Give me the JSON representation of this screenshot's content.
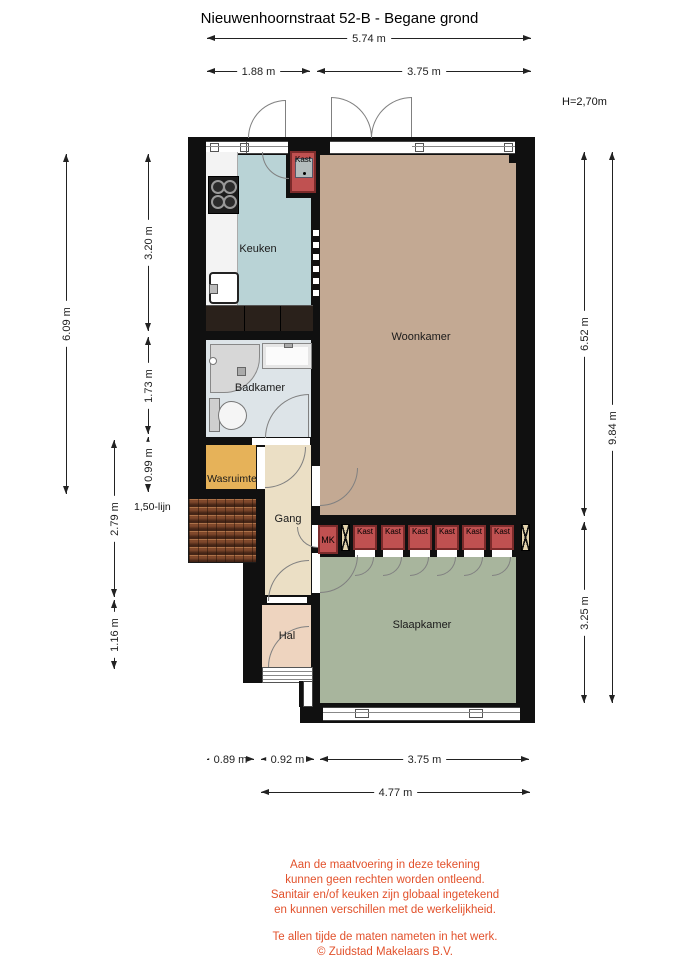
{
  "title": "Nieuwenhoornstraat 52-B - Begane grond",
  "labels": {
    "keuken": "Keuken",
    "woonkamer": "Woonkamer",
    "badkamer": "Badkamer",
    "wasruimte": "Wasruimte",
    "gang": "Gang",
    "hal": "Hal",
    "slaapkamer": "Slaapkamer",
    "kast": "Kast",
    "mk": "MK",
    "height": "H=2,70m",
    "line150": "1,50-lijn"
  },
  "dims": {
    "w_total": "5.74 m",
    "w_kitchen": "1.88 m",
    "w_living": "3.75 m",
    "h_left_total": "6.09 m",
    "h_kitchen": "3.20 m",
    "h_bath": "1.73 m",
    "h_wasruimte": "0.99 m",
    "h_gang": "2.79 m",
    "h_hal": "1.16 m",
    "h_right_upper": "6.52 m",
    "h_right_total": "9.84 m",
    "h_bedroom": "3.25 m",
    "b_left": "0.89 m",
    "b_mid": "0.92 m",
    "b_right": "3.75 m",
    "b_total": "4.77 m"
  },
  "disclaimer": {
    "lines": [
      "Aan de maatvoering in deze tekening",
      "kunnen geen rechten worden ontleend.",
      "Sanitair en/of keuken zijn globaal ingetekend",
      "en kunnen verschillen met de werkelijkheid."
    ],
    "notes": [
      "Te allen tijde de maten nameten in het werk.",
      "© Zuidstad Makelaars B.V."
    ]
  },
  "colors": {
    "wall": "#101010",
    "keuken": "#b9d3d6",
    "woonkamer": "#c3a993",
    "badkamer": "#dde4e8",
    "wasruimte": "#e6b259",
    "gang": "#ebdfc5",
    "hal": "#eed4bf",
    "slaapkamer": "#a8b59d",
    "kastred": "#c05151",
    "kastborder": "#7c2b2b",
    "xbox": "#e3d3ac",
    "tilesbase": "#7a452a",
    "accent": "#e2512b",
    "dim": "#222222",
    "arc": "#808080"
  }
}
